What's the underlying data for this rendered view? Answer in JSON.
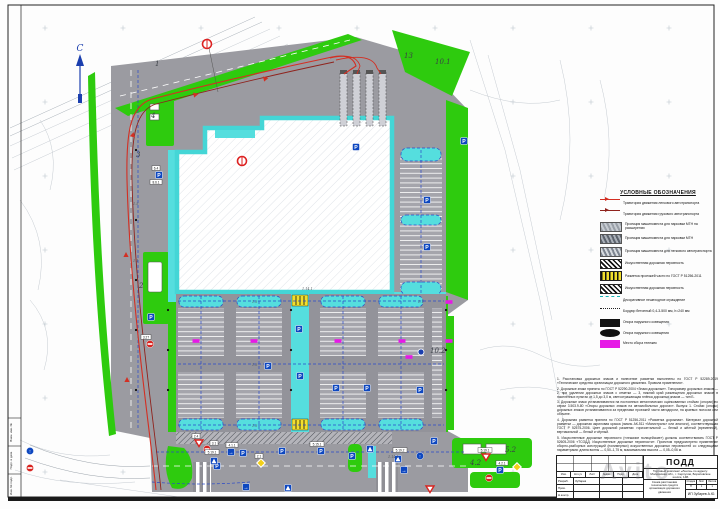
{
  "north": {
    "label": "С"
  },
  "watermark": "Avito",
  "legend": {
    "title": "УСЛОВНЫЕ ОБОЗНАЧЕНИЯ",
    "rows": [
      {
        "sw": "line",
        "label": "Траектория движения легкового автотранспорта"
      },
      {
        "sw": "line dark",
        "label": "Траектория движения грузового автотранспорта"
      },
      {
        "sw": "photo",
        "label": "Проекция машиноместа для парковки МГН на расширении"
      },
      {
        "sw": "photo v2",
        "label": "Проекция машиноместа для парковки МГН"
      },
      {
        "sw": "photo v3",
        "label": "Проекция машиноместа для легкового автотранспорта"
      },
      {
        "sw": "hump",
        "label": "Искусственная дорожная неровность"
      },
      {
        "sw": "ym",
        "label": "Разметка проезжей части по ГОСТ Р 51256-2011"
      },
      {
        "sw": "hump",
        "label": "Искусственная дорожная неровность"
      },
      {
        "sw": "fence",
        "label": "Декоративное пешеходное ограждение"
      },
      {
        "sw": "dot",
        "label": "Бордюр бетонный 0,4-3-500 мм, h=240 мм"
      },
      {
        "sw": "pole",
        "label": "Опора наружного освещения"
      },
      {
        "sw": "pole2",
        "label": "Опора наружного освещения"
      },
      {
        "sw": "cart",
        "label": "Место сбора тележек"
      }
    ]
  },
  "notes": {
    "items": [
      "1. Расстановка дорожных знаков и нанесение разметки выполнены по ГОСТ Р 52289-2019 «Технические средства организации дорожного движения. Правила применения».",
      "2. Дорожные знаки приняты по ГОСТ Р 52290-2004 «Знаки дорожные». Типоразмер дорожных знаков — 2, при удалении дорожных знаков с отметки — 3, нижний край размещения дорожных знаков в населённых пунктах от 1,5 до 3,0 м, светоотражающая плёнка дорожных знаков — тип Б.",
      "3. Дорожные знаки устанавливаются на постоянных металлических оцинкованных стойках (опорах) по серии 3.503.9-80 «Опоры дорожных знаков на автомобильных дорогах». Выпуск 1. Стойки (опоры) дорожных знаков устанавливаются за пределами проезжей части автодороги, на краевых полосах или обочине.",
      "4. Дорожная разметка принята по ГОСТ Р 51256-2011 «Разметка дорожная». Материал дорожной разметки — дорожная акриловая краска (эмаль АК-511 «Магистраль» или аналоги), соответствующая ГОСТ Р 52575-2006. Цвет дорожной разметки: горизонтальной — белый и жёлтый (временной), вертикальной — белый и чёрный.",
      "5. Искусственные дорожные неровности («лежачие полицейские») должны соответствовать ГОСТ Р 52605-2006 «ТСОДД. Искусственные дорожные неровности». Проектом предусмотрено применение сборно-разборных конструкций (полимерных) искусственных дорожных неровностей со следующими параметрами: длина волны — 0,50–1,75 м, максимальная высота — 0,05–0,06 м."
    ]
  },
  "title_block": {
    "code": "ПОДД",
    "object": "Торговый комплекс «Лента» по адресу: Московская обл., г. Серпухов, Борисовское шоссе, 14Б",
    "sheet_title": "Схема расстановки технических средств организации дорожного движения",
    "author": "ИП Зубарев А.Ю.",
    "head_cells": [
      "Изм.",
      "Кол.уч",
      "Лист",
      "№док.",
      "Подп.",
      "Дата"
    ],
    "people": [
      {
        "role": "Разраб.",
        "name": "Зубарев",
        "sig": "",
        "date": ""
      },
      {
        "role": "Пров.",
        "name": "",
        "sig": "",
        "date": ""
      },
      {
        "role": "Н.контр.",
        "name": "",
        "sig": "",
        "date": ""
      }
    ],
    "stage_labels": [
      "Стадия",
      "Лист",
      "Листов"
    ],
    "stage_values": [
      "П",
      "1",
      "1"
    ]
  },
  "frame": {
    "left_labels": [
      "Взам. инв. №",
      "Подп. и дата",
      "Инв. № подл."
    ]
  },
  "callouts": [
    {
      "t": "1",
      "x": 155,
      "y": 66
    },
    {
      "t": "4",
      "x": 151,
      "y": 118
    },
    {
      "t": "3",
      "x": 136,
      "y": 157
    },
    {
      "t": "2",
      "x": 139,
      "y": 288
    },
    {
      "t": "13",
      "x": 404,
      "y": 58
    },
    {
      "t": "10.1",
      "x": 435,
      "y": 64
    },
    {
      "t": "10.2",
      "x": 430,
      "y": 353
    },
    {
      "t": "5.2",
      "x": 505,
      "y": 452
    },
    {
      "t": "4.2",
      "x": 470,
      "y": 465
    }
  ],
  "signs": [
    {
      "t": "p",
      "x": 159,
      "y": 175
    },
    {
      "t": "p",
      "x": 151,
      "y": 317
    },
    {
      "t": "p",
      "x": 356,
      "y": 147
    },
    {
      "t": "p",
      "x": 464,
      "y": 141
    },
    {
      "t": "p",
      "x": 427,
      "y": 200
    },
    {
      "t": "p",
      "x": 427,
      "y": 247
    },
    {
      "t": "p",
      "x": 299,
      "y": 329
    },
    {
      "t": "p",
      "x": 268,
      "y": 366
    },
    {
      "t": "p",
      "x": 300,
      "y": 376
    },
    {
      "t": "p",
      "x": 336,
      "y": 388
    },
    {
      "t": "p",
      "x": 367,
      "y": 388
    },
    {
      "t": "p",
      "x": 420,
      "y": 390
    },
    {
      "t": "p",
      "x": 243,
      "y": 453
    },
    {
      "t": "p",
      "x": 282,
      "y": 451
    },
    {
      "t": "p",
      "x": 321,
      "y": 451
    },
    {
      "t": "p",
      "x": 352,
      "y": 456
    },
    {
      "t": "p",
      "x": 434,
      "y": 441
    },
    {
      "t": "p",
      "x": 217,
      "y": 466
    },
    {
      "t": "p",
      "x": 500,
      "y": 470
    },
    {
      "t": "walk",
      "x": 214,
      "y": 461
    },
    {
      "t": "walk",
      "x": 398,
      "y": 459
    },
    {
      "t": "walk",
      "x": 370,
      "y": 449
    },
    {
      "t": "walk",
      "x": 288,
      "y": 488
    },
    {
      "t": "arrow",
      "x": 231,
      "y": 452
    },
    {
      "t": "arrow",
      "x": 404,
      "y": 470
    },
    {
      "t": "arrow",
      "x": 246,
      "y": 487
    },
    {
      "t": "yield",
      "x": 199,
      "y": 443
    },
    {
      "t": "yield",
      "x": 430,
      "y": 489
    },
    {
      "t": "yield",
      "x": 486,
      "y": 457
    },
    {
      "t": "noentry",
      "x": 150,
      "y": 344
    },
    {
      "t": "noentry",
      "x": 207,
      "y": 449
    },
    {
      "t": "noentry",
      "x": 489,
      "y": 478
    },
    {
      "t": "noentry",
      "x": 30,
      "y": 468
    },
    {
      "t": "diamond",
      "x": 261,
      "y": 463
    },
    {
      "t": "diamond",
      "x": 517,
      "y": 467
    },
    {
      "t": "roundarrow",
      "x": 30,
      "y": 451
    },
    {
      "t": "roundarrow",
      "x": 420,
      "y": 456
    },
    {
      "t": "cart",
      "x": 196,
      "y": 341
    },
    {
      "t": "cart",
      "x": 254,
      "y": 341
    },
    {
      "t": "cart",
      "x": 338,
      "y": 341
    },
    {
      "t": "cart",
      "x": 402,
      "y": 341
    },
    {
      "t": "cart",
      "x": 449,
      "y": 302
    },
    {
      "t": "cart",
      "x": 449,
      "y": 341
    },
    {
      "t": "cart",
      "x": 409,
      "y": 357
    },
    {
      "t": "pole",
      "x": 168,
      "y": 310
    },
    {
      "t": "pole",
      "x": 168,
      "y": 350
    },
    {
      "t": "pole",
      "x": 168,
      "y": 390
    },
    {
      "t": "pole",
      "x": 446,
      "y": 310
    },
    {
      "t": "pole",
      "x": 446,
      "y": 350
    },
    {
      "t": "pole",
      "x": 446,
      "y": 390
    },
    {
      "t": "pole",
      "x": 136,
      "y": 150
    },
    {
      "t": "pole",
      "x": 136,
      "y": 220
    },
    {
      "t": "pole",
      "x": 136,
      "y": 280
    },
    {
      "t": "pole",
      "x": 136,
      "y": 330
    },
    {
      "t": "pole",
      "x": 136,
      "y": 390
    },
    {
      "t": "pole",
      "x": 291,
      "y": 310
    },
    {
      "t": "pole",
      "x": 291,
      "y": 350
    },
    {
      "t": "pole",
      "x": 291,
      "y": 390
    }
  ],
  "sign_glyphs": {
    "p": "P",
    "arrow": "→",
    "roundarrow": "↑"
  },
  "flags": [
    {
      "t": "5.19.1",
      "x": 212,
      "y": 452
    },
    {
      "t": "5.19.2",
      "x": 400,
      "y": 450
    },
    {
      "t": "2.4",
      "x": 196,
      "y": 436
    },
    {
      "t": "3.1",
      "x": 214,
      "y": 443
    },
    {
      "t": "4.1.1",
      "x": 232,
      "y": 445
    },
    {
      "t": "2.1",
      "x": 259,
      "y": 456
    },
    {
      "t": "5.15.1",
      "x": 317,
      "y": 444
    },
    {
      "t": "6.4",
      "x": 156,
      "y": 168
    },
    {
      "t": "8.6.1",
      "x": 156,
      "y": 182
    },
    {
      "t": "3.27",
      "x": 146,
      "y": 337
    },
    {
      "t": "5.19.1",
      "x": 485,
      "y": 450
    },
    {
      "t": "4.2.1",
      "x": 502,
      "y": 463
    }
  ],
  "mark_labels": [
    {
      "t": "1.5",
      "x": 133,
      "y": 205
    },
    {
      "t": "1.1",
      "x": 133,
      "y": 262
    },
    {
      "t": "1.5",
      "x": 252,
      "y": 303
    },
    {
      "t": "1.14.1",
      "x": 302,
      "y": 290
    },
    {
      "t": "1.5",
      "x": 252,
      "y": 366
    },
    {
      "t": "1.1",
      "x": 418,
      "y": 303
    },
    {
      "t": "1.5",
      "x": 252,
      "y": 427
    },
    {
      "t": "1.14.1",
      "x": 388,
      "y": 458
    }
  ]
}
